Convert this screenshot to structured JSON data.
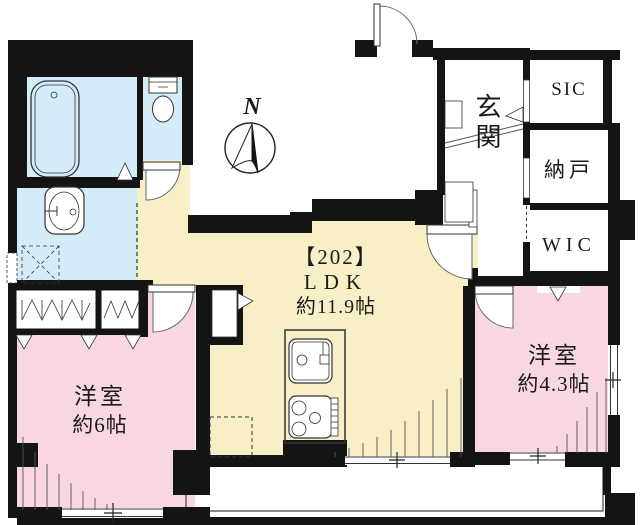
{
  "unit": {
    "number": "【202】"
  },
  "rooms": {
    "ldk": {
      "name": "LDK",
      "size": "約11.9帖"
    },
    "bedroom_left": {
      "name": "洋室",
      "size": "約6帖"
    },
    "bedroom_right": {
      "name": "洋室",
      "size": "約4.3帖"
    },
    "entrance": {
      "name": "玄関"
    },
    "shoes_in_closet": {
      "name": "SIC"
    },
    "storage_room": {
      "name": "納戸"
    },
    "walk_in_closet": {
      "name": "WIC"
    }
  },
  "compass": {
    "north": "N"
  },
  "colors": {
    "wall": "#141414",
    "ldk_floor": "#F9EFC7",
    "bedroom_floor": "#F8D7E2",
    "wet_floor": "#D4ECF7",
    "outline": "#333333",
    "background": "#FFFFFF"
  }
}
